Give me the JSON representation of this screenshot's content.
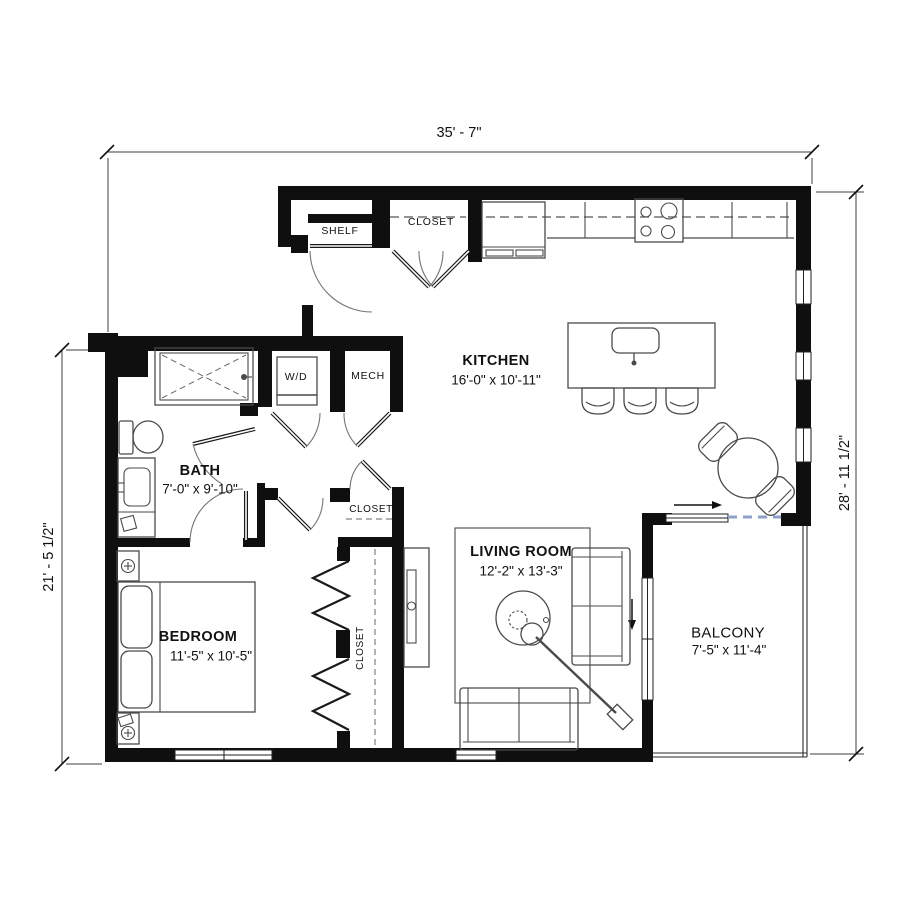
{
  "dimensions": {
    "top": "35' - 7\"",
    "right": "28' - 11 1/2\"",
    "left": "21' - 5 1/2\""
  },
  "rooms": {
    "kitchen": {
      "name": "KITCHEN",
      "size": "16'-0\" x 10'-11\""
    },
    "living_room": {
      "name": "LIVING ROOM",
      "size": "12'-2\" x 13'-3\""
    },
    "bedroom": {
      "name": "BEDROOM",
      "size": "11'-5\" x 10'-5\""
    },
    "bath": {
      "name": "BATH",
      "size": "7'-0\" x 9'-10\""
    },
    "balcony": {
      "name": "BALCONY",
      "size": "7'-5\" x 11'-4\""
    }
  },
  "labels": {
    "shelf": "SHELF",
    "entry_closet": "CLOSET",
    "hall_closet": "CLOSET",
    "bedroom_closet": "CLOSET",
    "washer_dryer": "W/D",
    "mechanical": "MECH"
  },
  "colors": {
    "wall": "#0f0f0f",
    "dimension_line": "#3d3d3d",
    "furniture_line": "#4a4a4a",
    "door_arc": "#757575",
    "slider_dash": "#8fa0c8",
    "background": "#ffffff"
  }
}
